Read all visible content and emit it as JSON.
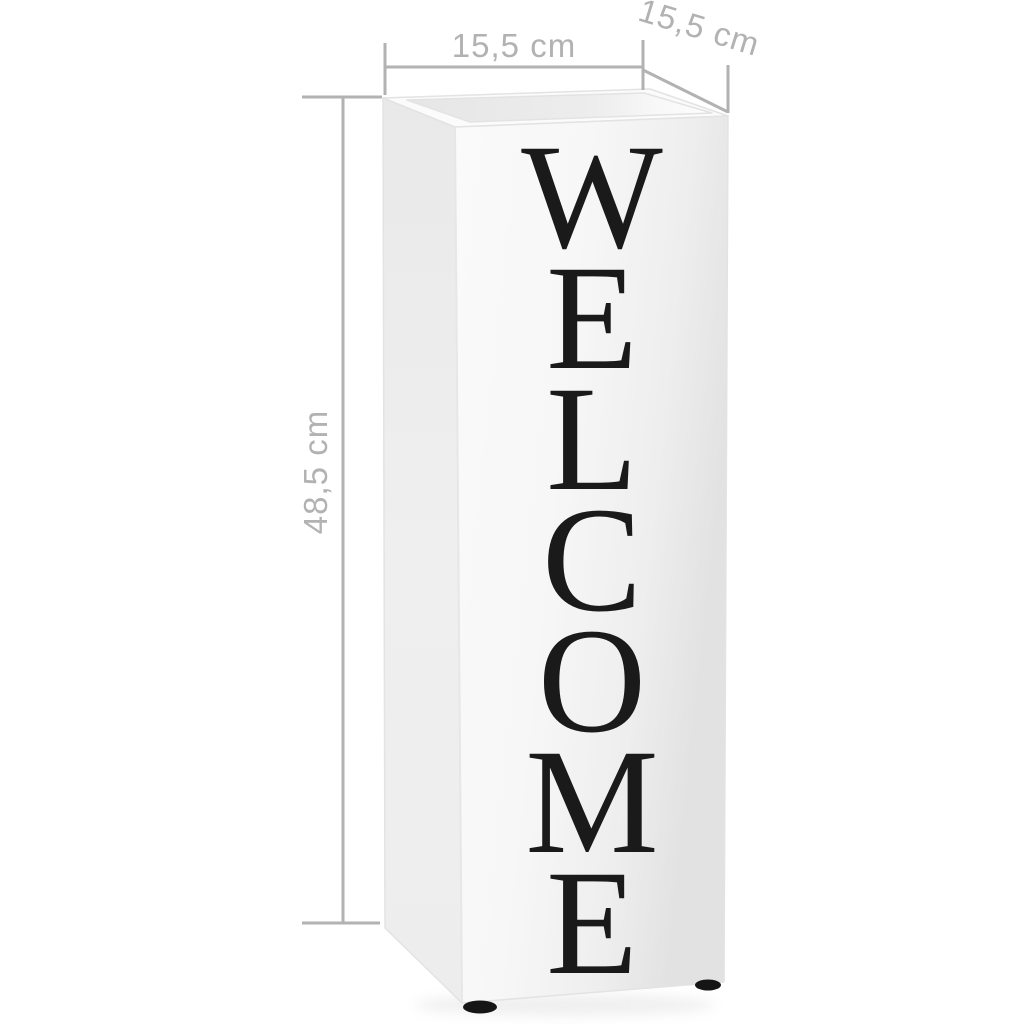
{
  "image_type": "product-dimension-diagram",
  "product": {
    "description": "white steel umbrella stand with vertical welcome lettering",
    "text": "WELCOME",
    "letters": [
      "W",
      "E",
      "L",
      "C",
      "O",
      "M",
      "E"
    ]
  },
  "dimensions": {
    "width": {
      "label": "15,5 cm"
    },
    "depth": {
      "label": "15,5 cm"
    },
    "height": {
      "label": "48,5 cm"
    }
  },
  "colors": {
    "annotation": "#b2b2b2",
    "letters": "#1a1a1a",
    "feet": "#151515",
    "background": "#ffffff"
  }
}
